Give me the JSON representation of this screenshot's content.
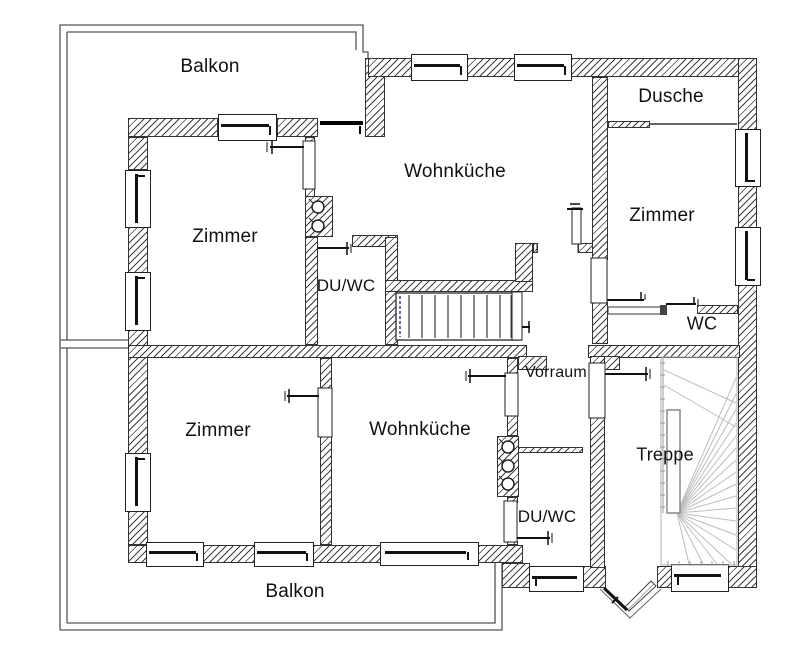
{
  "floorplan": {
    "title": "Apartment floor plan",
    "rooms": [
      {
        "id": "balkon-top",
        "label": "Balkon"
      },
      {
        "id": "zimmer-upper-left",
        "label": "Zimmer"
      },
      {
        "id": "wohnkueche-upper",
        "label": "Wohnküche"
      },
      {
        "id": "dusche",
        "label": "Dusche"
      },
      {
        "id": "zimmer-right",
        "label": "Zimmer"
      },
      {
        "id": "duwc-upper",
        "label": "DU/WC"
      },
      {
        "id": "wc",
        "label": "WC"
      },
      {
        "id": "vorraum",
        "label": "Vorraum"
      },
      {
        "id": "zimmer-lower-left",
        "label": "Zimmer"
      },
      {
        "id": "wohnkueche-lower",
        "label": "Wohnküche"
      },
      {
        "id": "treppe",
        "label": "Treppe"
      },
      {
        "id": "duwc-lower",
        "label": "DU/WC"
      },
      {
        "id": "balkon-bottom",
        "label": "Balkon"
      }
    ],
    "colors": {
      "wall_line": "#333333",
      "hatch": "#3d3d3d",
      "door": "#111111",
      "stair_tread": "#bdbdbd",
      "stair_guide_blue": "#2b3f8c",
      "balcony_outline": "#555555"
    }
  }
}
